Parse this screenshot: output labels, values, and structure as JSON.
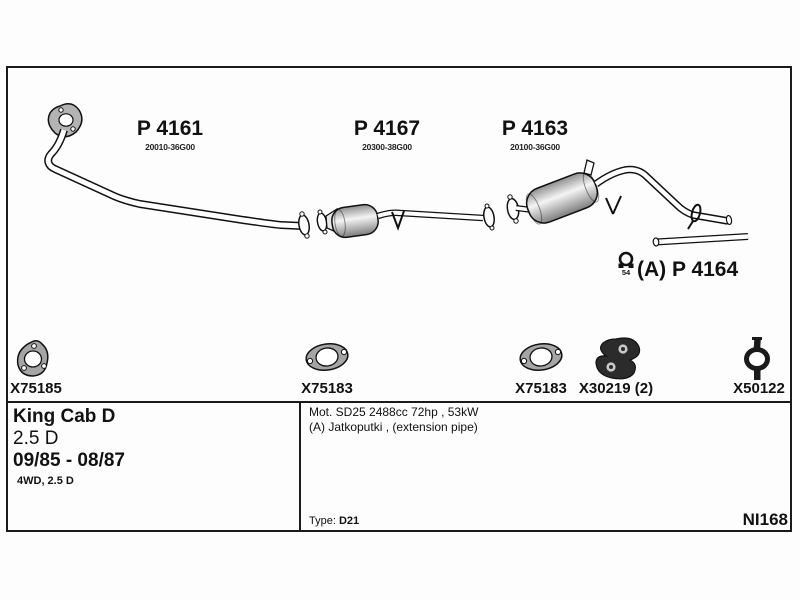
{
  "parts": [
    {
      "code": "P 4161",
      "oem": "20010-36G00"
    },
    {
      "code": "P 4167",
      "oem": "20300-38G00"
    },
    {
      "code": "P 4163",
      "oem": "20100-36G00"
    }
  ],
  "extension_part": {
    "code": "(A) P 4164",
    "clamp_size": "54"
  },
  "fittings": [
    {
      "code": "X75185"
    },
    {
      "code": "X75183"
    },
    {
      "code": "X75183"
    },
    {
      "code": "X30219 (2)"
    },
    {
      "code": "X50122"
    }
  ],
  "vehicle": {
    "model": "King Cab D",
    "engine": "2.5 D",
    "years": "09/85 - 08/87",
    "variant": "4WD, 2.5 D"
  },
  "engine_note": "Mot. SD25 2488cc 72hp , 53kW",
  "extension_note": "(A) Jatkoputki , (extension pipe)",
  "type_info": {
    "label": "Type:",
    "value": "D21"
  },
  "doc_code": "NI168",
  "colors": {
    "ink": "#1a1a1a",
    "metal": "#a8a8a8",
    "rubber": "#2b2b2b"
  }
}
